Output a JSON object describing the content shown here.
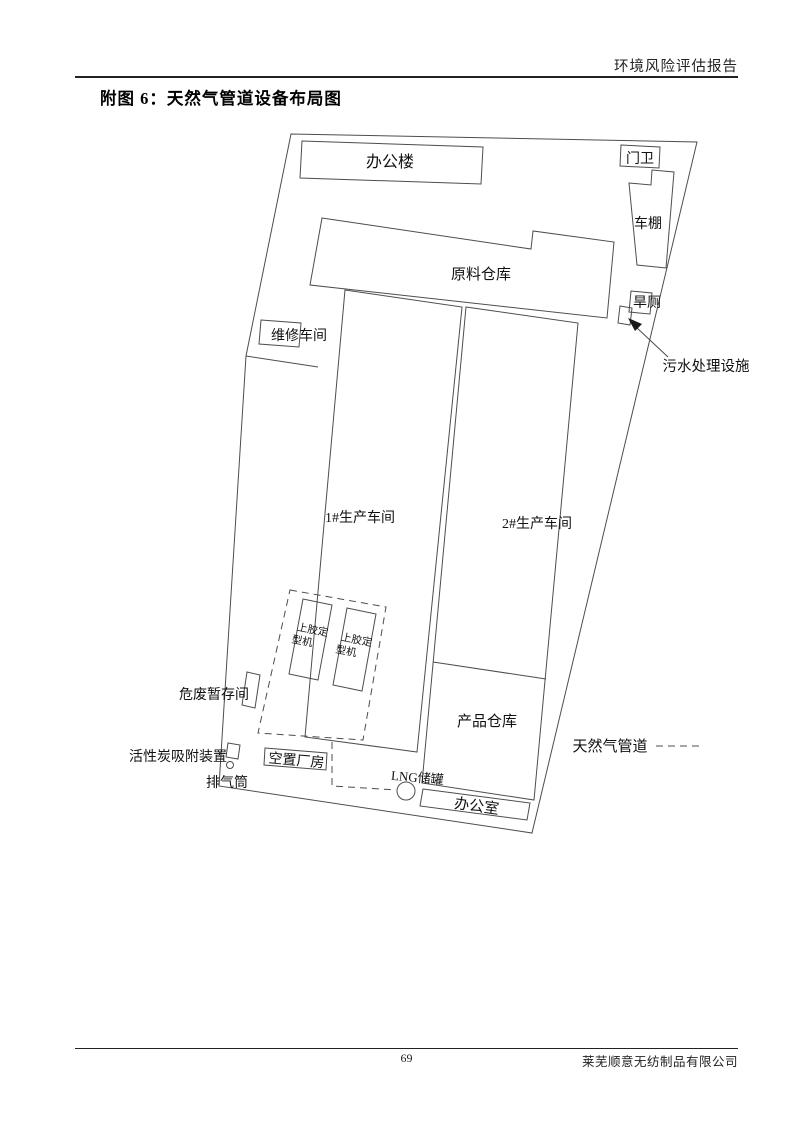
{
  "page": {
    "header": "环境风险评估报告",
    "title": "附图 6：天然气管道设备布局图",
    "footer": {
      "page_number": "69",
      "company": "莱芜顺意无纺制品有限公司"
    }
  },
  "diagram": {
    "buildings": {
      "office_building": "办公楼",
      "gate_guard": "门卫",
      "carport": "车棚",
      "raw_material_warehouse": "原料仓库",
      "maintenance_workshop": "维修车间",
      "dry_toilet": "旱厕",
      "workshop_1": "1#生产车间",
      "workshop_2": "2#生产车间",
      "product_warehouse": "产品仓库",
      "vacant_building": "空置厂房",
      "office_room": "办公室"
    },
    "equipment": {
      "gluing_machine_line1": "上胶定",
      "gluing_machine_line2": "型机",
      "hazardous_waste_room": "危废暂存间",
      "activated_carbon_device": "活性炭吸附装置",
      "exhaust_stack": "排气筒",
      "lng_tank": "LNG储罐",
      "sewage_treatment": "污水处理设施"
    },
    "legend": {
      "gas_pipeline": "天然气管道"
    }
  }
}
